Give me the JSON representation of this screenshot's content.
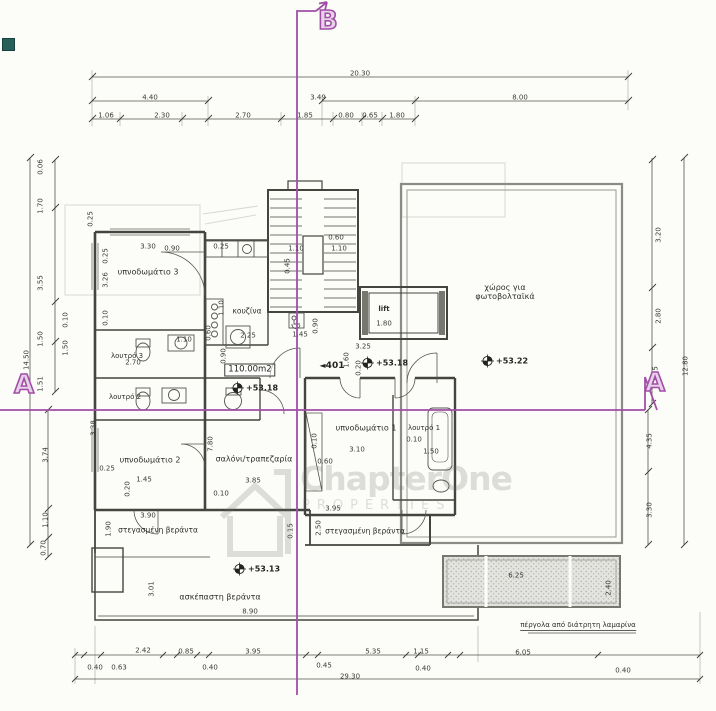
{
  "drawing": {
    "type": "floor-plan",
    "unit": {
      "number": "401",
      "area_label": "110.00m2",
      "lift_label": "lift"
    },
    "section_markers": {
      "b": "B",
      "a_left": "A",
      "a_right": "A"
    },
    "watermark": {
      "brand": "ChapterOne",
      "sub": "PROPERTIES"
    },
    "colors": {
      "ink": "#3a3a36",
      "wall_gray": "#8b8b85",
      "section_purple": "#a14fa6",
      "paper": "#fcfcf9"
    }
  },
  "rooms": [
    {
      "t": "υπνοδωμάτιο 3",
      "x": 148,
      "y": 272
    },
    {
      "t": "λουτρό 3",
      "x": 127,
      "y": 356,
      "s": 7
    },
    {
      "t": "λουτρό 2",
      "x": 125,
      "y": 397,
      "s": 7
    },
    {
      "t": "υπνοδωμάτιο 2",
      "x": 150,
      "y": 460
    },
    {
      "t": "σαλόνι/τραπεζαρία",
      "x": 254,
      "y": 459
    },
    {
      "t": "κουζίνα",
      "x": 247,
      "y": 312,
      "s": 7.5
    },
    {
      "t": "υπνοδωμάτιο 1",
      "x": 366,
      "y": 428
    },
    {
      "t": "λουτρό 1",
      "x": 424,
      "y": 428,
      "s": 7
    },
    {
      "t": "lift",
      "x": 384,
      "y": 309,
      "s": 7,
      "b": 1
    },
    {
      "t": "χώρος για\nφωτοβολταϊκά",
      "x": 505,
      "y": 292
    },
    {
      "t": "στεγασμένη βεράντα",
      "x": 158,
      "y": 531,
      "s": 7.5
    },
    {
      "t": "στεγασμένη βεράντα",
      "x": 365,
      "y": 532,
      "s": 7.5
    },
    {
      "t": "ασκέπαστη βεράντα",
      "x": 220,
      "y": 597
    },
    {
      "t": "πέργολα από διάτρητη λαμαρίνα",
      "x": 578,
      "y": 626,
      "s": 7,
      "u": 1
    }
  ],
  "elevations": [
    {
      "v": "+53.18",
      "x": 238,
      "y": 388
    },
    {
      "v": "+53.18",
      "x": 368,
      "y": 363
    },
    {
      "v": "+53.22",
      "x": 488,
      "y": 361
    },
    {
      "v": "+53.13",
      "x": 240,
      "y": 569
    }
  ],
  "dimensions": [
    {
      "t": "20.30",
      "x": 360,
      "y": 74
    },
    {
      "t": "4.40",
      "x": 150,
      "y": 98
    },
    {
      "t": "3.49",
      "x": 318,
      "y": 98
    },
    {
      "t": "8.00",
      "x": 520,
      "y": 98
    },
    {
      "t": "1.06",
      "x": 106,
      "y": 116
    },
    {
      "t": "2.30",
      "x": 162,
      "y": 116
    },
    {
      "t": "2.70",
      "x": 243,
      "y": 116
    },
    {
      "t": "1.85",
      "x": 305,
      "y": 116
    },
    {
      "t": "0.80",
      "x": 346,
      "y": 116
    },
    {
      "t": "0.65",
      "x": 370,
      "y": 116
    },
    {
      "t": "1.80",
      "x": 397,
      "y": 116
    },
    {
      "t": "0.06",
      "x": 41,
      "y": 167,
      "r": 1
    },
    {
      "t": "1.70",
      "x": 41,
      "y": 206,
      "r": 1
    },
    {
      "t": "3.55",
      "x": 41,
      "y": 283,
      "r": 1
    },
    {
      "t": "1.50",
      "x": 41,
      "y": 339,
      "r": 1
    },
    {
      "t": "1.51",
      "x": 41,
      "y": 384,
      "r": 1
    },
    {
      "t": "14.50",
      "x": 27,
      "y": 360,
      "r": 1
    },
    {
      "t": "3.74",
      "x": 46,
      "y": 455,
      "r": 1
    },
    {
      "t": "1.10",
      "x": 46,
      "y": 520,
      "r": 1
    },
    {
      "t": "0.70",
      "x": 44,
      "y": 548,
      "r": 1
    },
    {
      "t": "3.20",
      "x": 659,
      "y": 235,
      "r": 1
    },
    {
      "t": "2.80",
      "x": 659,
      "y": 316,
      "r": 1
    },
    {
      "t": "1.15",
      "x": 656,
      "y": 374,
      "r": 1
    },
    {
      "t": "12.80",
      "x": 686,
      "y": 366,
      "r": 1
    },
    {
      "t": "4.35",
      "x": 650,
      "y": 441,
      "r": 1
    },
    {
      "t": "3.30",
      "x": 650,
      "y": 510,
      "r": 1
    },
    {
      "t": "2.42",
      "x": 143,
      "y": 651
    },
    {
      "t": "0.85",
      "x": 186,
      "y": 652
    },
    {
      "t": "3.95",
      "x": 253,
      "y": 652
    },
    {
      "t": "5.35",
      "x": 373,
      "y": 652
    },
    {
      "t": "1.15",
      "x": 421,
      "y": 652
    },
    {
      "t": "6.05",
      "x": 523,
      "y": 653
    },
    {
      "t": "0.40",
      "x": 95,
      "y": 668
    },
    {
      "t": "0.63",
      "x": 119,
      "y": 668
    },
    {
      "t": "0.40",
      "x": 210,
      "y": 668
    },
    {
      "t": "0.45",
      "x": 324,
      "y": 666
    },
    {
      "t": "0.40",
      "x": 423,
      "y": 669
    },
    {
      "t": "0.40",
      "x": 623,
      "y": 671
    },
    {
      "t": "29.30",
      "x": 350,
      "y": 677
    },
    {
      "t": "3.30",
      "x": 148,
      "y": 247
    },
    {
      "t": "0.90",
      "x": 172,
      "y": 249
    },
    {
      "t": "0.25",
      "x": 221,
      "y": 247
    },
    {
      "t": "0.25",
      "x": 91,
      "y": 219,
      "r": 1
    },
    {
      "t": "0.25",
      "x": 106,
      "y": 256,
      "r": 1
    },
    {
      "t": "3.26",
      "x": 106,
      "y": 280,
      "r": 1
    },
    {
      "t": "0.10",
      "x": 106,
      "y": 318,
      "r": 1
    },
    {
      "t": "0.10",
      "x": 66,
      "y": 320,
      "r": 1
    },
    {
      "t": "1.50",
      "x": 66,
      "y": 348,
      "r": 1
    },
    {
      "t": "2.70",
      "x": 133,
      "y": 363
    },
    {
      "t": "1.10",
      "x": 184,
      "y": 340
    },
    {
      "t": "1.10",
      "x": 222,
      "y": 308,
      "r": 1
    },
    {
      "t": "0.60",
      "x": 209,
      "y": 333,
      "r": 1
    },
    {
      "t": "0.90",
      "x": 224,
      "y": 356,
      "r": 1
    },
    {
      "t": "2.25",
      "x": 248,
      "y": 336
    },
    {
      "t": "0.60",
      "x": 336,
      "y": 238
    },
    {
      "t": "1.10",
      "x": 296,
      "y": 249
    },
    {
      "t": "1.10",
      "x": 339,
      "y": 249
    },
    {
      "t": "0.45",
      "x": 288,
      "y": 266,
      "r": 1
    },
    {
      "t": "1.80",
      "x": 384,
      "y": 324
    },
    {
      "t": "3.25",
      "x": 363,
      "y": 347
    },
    {
      "t": "1.60",
      "x": 347,
      "y": 360,
      "r": 1
    },
    {
      "t": "0.20",
      "x": 359,
      "y": 368,
      "r": 1
    },
    {
      "t": "1.45",
      "x": 300,
      "y": 335
    },
    {
      "t": "0.90",
      "x": 316,
      "y": 326,
      "r": 1
    },
    {
      "t": "3.38",
      "x": 94,
      "y": 428,
      "r": 1
    },
    {
      "t": "0.25",
      "x": 107,
      "y": 469
    },
    {
      "t": "1.45",
      "x": 144,
      "y": 480
    },
    {
      "t": "0.20",
      "x": 128,
      "y": 489,
      "r": 1
    },
    {
      "t": "7.80",
      "x": 211,
      "y": 444,
      "r": 1
    },
    {
      "t": "3.85",
      "x": 253,
      "y": 481
    },
    {
      "t": "0.10",
      "x": 221,
      "y": 494
    },
    {
      "t": "3.10",
      "x": 357,
      "y": 450
    },
    {
      "t": "0.60",
      "x": 325,
      "y": 462
    },
    {
      "t": "0.10",
      "x": 315,
      "y": 441,
      "r": 1
    },
    {
      "t": "0.10",
      "x": 414,
      "y": 440
    },
    {
      "t": "1.50",
      "x": 431,
      "y": 452
    },
    {
      "t": "3.90",
      "x": 148,
      "y": 516
    },
    {
      "t": "1.90",
      "x": 109,
      "y": 529,
      "r": 1
    },
    {
      "t": "2.50",
      "x": 319,
      "y": 528,
      "r": 1
    },
    {
      "t": "0.15",
      "x": 291,
      "y": 531,
      "r": 1
    },
    {
      "t": "3.95",
      "x": 333,
      "y": 509
    },
    {
      "t": "3.01",
      "x": 152,
      "y": 589,
      "r": 1
    },
    {
      "t": "8.90",
      "x": 250,
      "y": 612
    },
    {
      "t": "6.25",
      "x": 516,
      "y": 576
    },
    {
      "t": "2.40",
      "x": 609,
      "y": 588,
      "r": 1
    }
  ]
}
